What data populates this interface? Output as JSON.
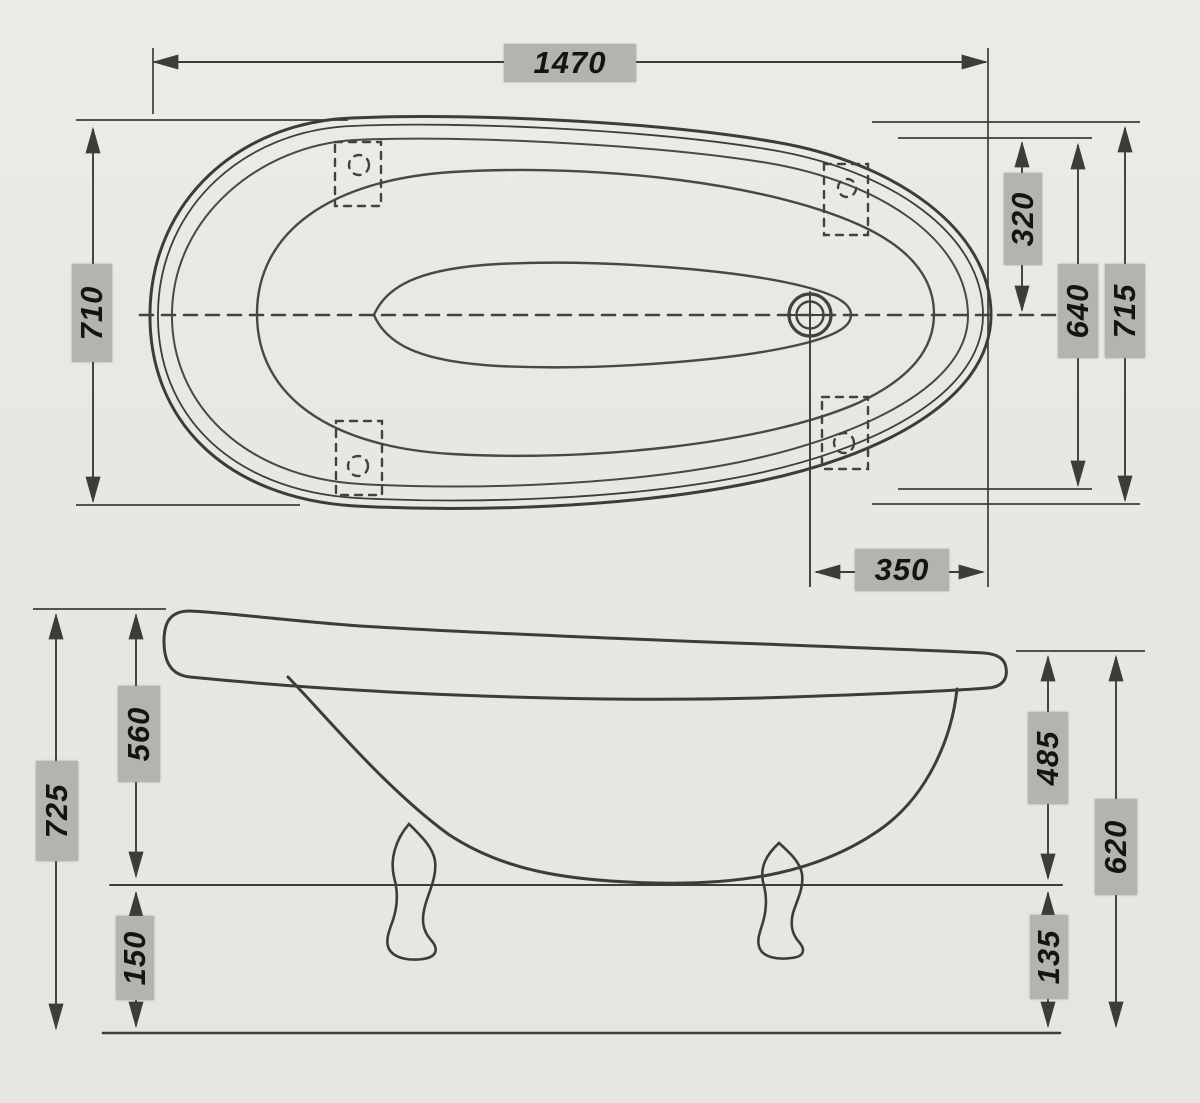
{
  "drawing": {
    "name": "clawfoot-bathtub-dimension-drawing",
    "views": {
      "top_view": "top view",
      "side_view": "side view"
    },
    "colors": {
      "paper": "#e9e7e1",
      "line": "#3e3c38",
      "inner_line": "#55534e",
      "label_bg": "#b4b3af",
      "label_text": "#151413"
    },
    "top_view": {
      "dims": {
        "overall_length": "1470",
        "overall_width_left": "710",
        "center_to_rim_top": "320",
        "rim_inner_width": "640",
        "overall_width_right": "715",
        "drain_to_end": "350"
      }
    },
    "side_view": {
      "dims": {
        "overall_height_back": "725",
        "body_height_back": "560",
        "leg_height_back": "150",
        "body_height_front": "485",
        "overall_height_front": "620",
        "leg_height_front": "135"
      }
    }
  }
}
